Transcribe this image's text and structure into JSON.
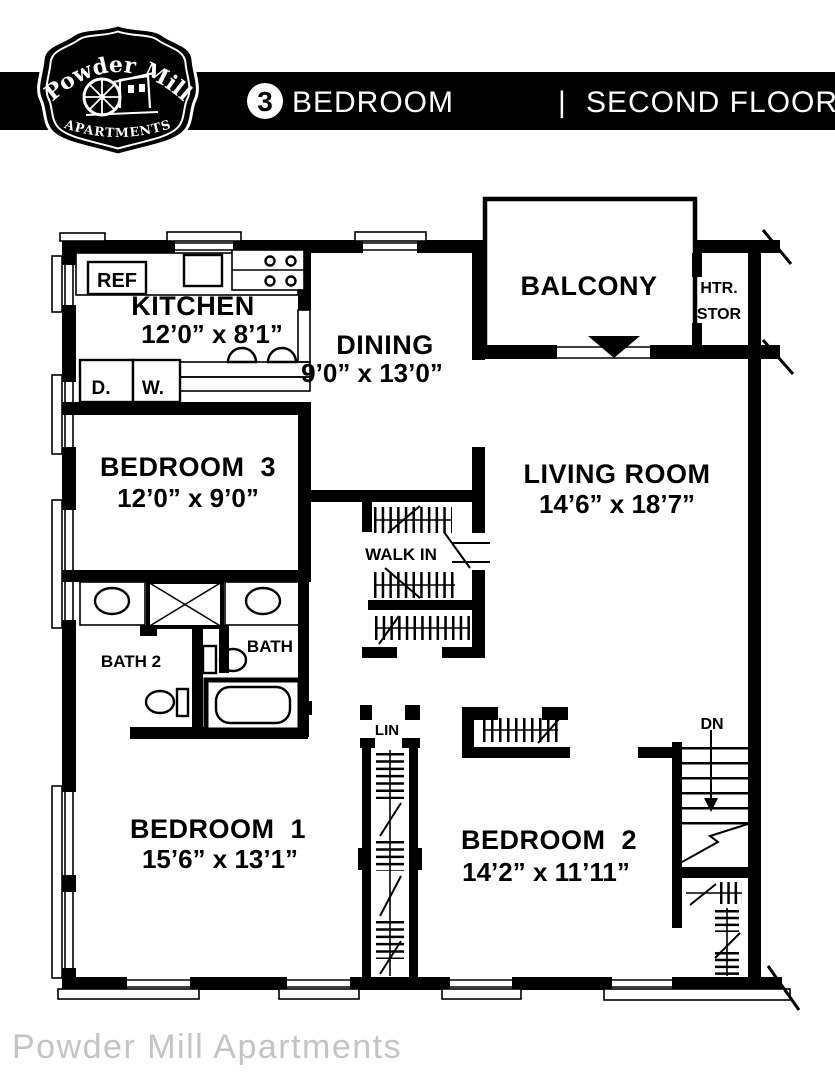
{
  "header": {
    "logo": {
      "line1": "Powder Mill",
      "line2": "APARTMENTS"
    },
    "unit_number": "3",
    "title_left": "BEDROOM",
    "separator": "|",
    "title_right": "SECOND FLOOR PLAN"
  },
  "rooms": {
    "kitchen": {
      "name": "KITCHEN",
      "dims": "12’0” x 8’1”"
    },
    "dining": {
      "name": "DINING",
      "dims": "9’0” x 13’0”"
    },
    "balcony": {
      "name": "BALCONY"
    },
    "heater_storage": {
      "line1": "HTR.",
      "line2": "STOR"
    },
    "bedroom3": {
      "name": "BEDROOM  3",
      "dims": "12’0” x 9’0”"
    },
    "living_room": {
      "name": "LIVING ROOM",
      "dims": "14’6” x 18’7”"
    },
    "walk_in": {
      "name": "WALK IN"
    },
    "bath1": {
      "name": "BATH 1"
    },
    "bath2": {
      "name": "BATH 2"
    },
    "bedroom1": {
      "name": "BEDROOM  1",
      "dims": "15’6” x 13’1”"
    },
    "bedroom2": {
      "name": "BEDROOM  2",
      "dims": "14’2” x 11’11”"
    },
    "linen": {
      "name": "LIN"
    },
    "stairs": {
      "label": "DN"
    }
  },
  "fixtures": {
    "refrigerator": "REF",
    "dryer": "D.",
    "washer": "W."
  },
  "footer": {
    "watermark": "Powder Mill Apartments"
  },
  "colors": {
    "plan_line": "#000000",
    "header_bg": "#000000",
    "header_text": "#ffffff",
    "watermark_text": "#c4c4c4",
    "background": "#ffffff"
  }
}
